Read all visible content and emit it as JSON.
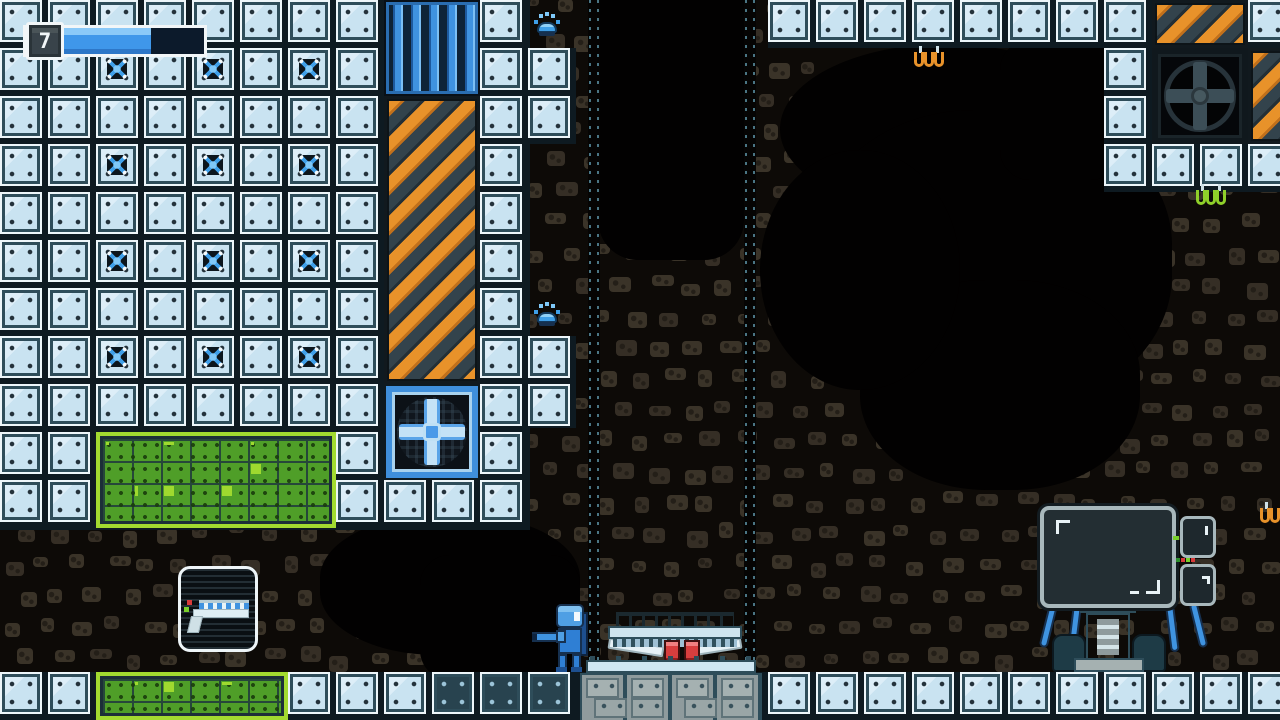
{
  "hud": {
    "level": "7",
    "health_percent": 70
  },
  "palette": {
    "cave_bg": "#0d0a07",
    "cave_black": "#020101",
    "rock": "#352e25",
    "rock_light": "#3a3328",
    "tile_fill": "#c9e3f1",
    "tile_frame": "#2e4d5a",
    "tile_edge": "#edf6fa",
    "tile_dark_fill": "#28434f",
    "bolt_blue": "#3f9fe8",
    "vent_blue": "#3f93e0",
    "hazard_orange": "#e8922a",
    "hazard_slate": "#33434c",
    "green_main": "#4f9e28",
    "green_lime": "#a2da30",
    "player_blue": "#2f7fd4",
    "enemy_red": "#d83e3e",
    "hud_fill": "#3f97ea",
    "machine_gray": "#8f9b9d",
    "monitor_trim": "#a8b8bc"
  },
  "level": {
    "tile_size": 48,
    "legend": {
      "T": "light-tile",
      "B": "bolt-tile",
      "D": "dark-tile",
      ".": "empty"
    },
    "tilemap": [
      "TTTTTTTT..T.....TTTTTTTT..T",
      "TTBTBTBT..TT...........T...",
      "TTTTTTTT..TT...........T...",
      "TTBTBTBT..T............TTTT",
      "TTTTTTTT..T................",
      "TTBTBTBT..T................",
      "TTTTTTTT..T................",
      "TTBTBTBT..TT...............",
      "TTTTTTTT..TT...............",
      "TT.....T..T................",
      "TT.....TTTT................",
      "...........................",
      "...........................",
      "...........................",
      "TT....TTTDDD....TTTTTTTTTTT"
    ],
    "panels": [
      {
        "type": "vent",
        "x": 384,
        "y": 0,
        "w": 96,
        "h": 96
      },
      {
        "type": "hazard",
        "x": 384,
        "y": 96,
        "w": 96,
        "h": 288
      },
      {
        "type": "hazard",
        "x": 1152,
        "y": 0,
        "w": 96,
        "h": 48
      },
      {
        "type": "hazard",
        "x": 1248,
        "y": 48,
        "w": 48,
        "h": 96
      },
      {
        "type": "fan_blue",
        "x": 384,
        "y": 384,
        "w": 96,
        "h": 96
      },
      {
        "type": "fan_dark",
        "x": 1152,
        "y": 48,
        "w": 96,
        "h": 96
      },
      {
        "type": "green",
        "x": 96,
        "y": 432,
        "w": 240,
        "h": 96
      },
      {
        "type": "green",
        "x": 96,
        "y": 672,
        "w": 192,
        "h": 48
      }
    ],
    "backings": [
      {
        "x": 0,
        "y": 0,
        "w": 530,
        "h": 530
      },
      {
        "x": 768,
        "y": 0,
        "w": 336,
        "h": 48
      },
      {
        "x": 1104,
        "y": 0,
        "w": 176,
        "h": 192
      },
      {
        "x": 0,
        "y": 672,
        "w": 1280,
        "h": 48
      },
      {
        "x": 528,
        "y": 48,
        "w": 48,
        "h": 96
      },
      {
        "x": 528,
        "y": 336,
        "w": 48,
        "h": 92
      }
    ],
    "seams": [
      588,
      744
    ],
    "cavities": [
      {
        "x": 598,
        "y": -40,
        "w": 146,
        "h": 300,
        "r": "40px"
      },
      {
        "x": 780,
        "y": 44,
        "w": 330,
        "h": 170,
        "r": "50%"
      },
      {
        "x": 812,
        "y": 110,
        "w": 360,
        "h": 300,
        "r": "45%"
      },
      {
        "x": 860,
        "y": 280,
        "w": 280,
        "h": 210,
        "r": "45%"
      },
      {
        "x": 760,
        "y": 150,
        "w": 200,
        "h": 240,
        "r": "50%"
      },
      {
        "x": 1000,
        "y": 40,
        "w": 120,
        "h": 140,
        "r": "30px"
      },
      {
        "x": 320,
        "y": 515,
        "w": 260,
        "h": 140,
        "r": "45%"
      },
      {
        "x": 420,
        "y": 555,
        "w": 160,
        "h": 125,
        "r": "30px"
      }
    ]
  },
  "entities": {
    "player": {
      "x": 532,
      "y": 604
    },
    "walker": {
      "x": 608,
      "y": 612
    },
    "bugs": [
      {
        "x": 534,
        "y": 12
      },
      {
        "x": 534,
        "y": 302
      }
    ],
    "coils": [
      {
        "x": 912,
        "y": 46,
        "color": "orange"
      },
      {
        "x": 1194,
        "y": 184,
        "color": "green"
      },
      {
        "x": 1258,
        "y": 502,
        "color": "orange"
      }
    ],
    "pickup": {
      "x": 178,
      "y": 566
    },
    "monitor_bot": {
      "x": 1040,
      "y": 506
    },
    "machine": {
      "x": 580,
      "y": 656
    }
  }
}
